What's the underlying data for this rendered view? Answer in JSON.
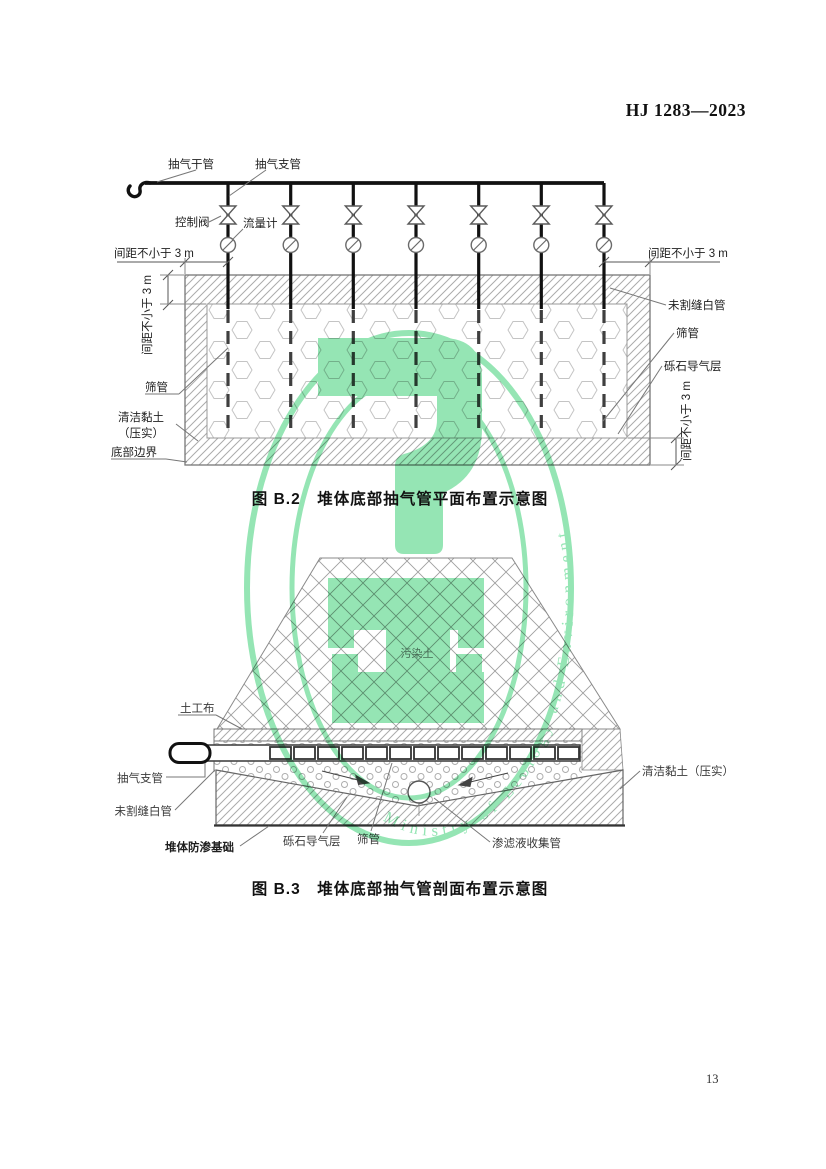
{
  "page": {
    "header": "HJ 1283—2023",
    "page_number": "13"
  },
  "figure_b2": {
    "caption": "图 B.2　堆体底部抽气管平面布置示意图",
    "labels": {
      "main_pipe": "抽气干管",
      "branch_pipe": "抽气支管",
      "control_valve": "控制阀",
      "flow_meter": "流量计",
      "spacing_top_left": "间距不小于 3 m",
      "spacing_top_right": "间距不小于 3 m",
      "spacing_side_left": "间距不小于 3 m",
      "spacing_side_right": "间距不小于 3 m",
      "unslotted_pipe": "未割缝白管",
      "screen_pipe_right": "筛管",
      "gravel_gas_layer": "砾石导气层",
      "screen_pipe_left": "筛管",
      "clean_clay_line1": "清洁黏土",
      "clean_clay_line2": "（压实）",
      "bottom_boundary": "底部边界"
    }
  },
  "figure_b3": {
    "caption": "图 B.3　堆体底部抽气管剖面布置示意图",
    "labels": {
      "geotextile": "土工布",
      "contaminated_soil": "污染土",
      "branch_pipe": "抽气支管",
      "unslotted_pipe": "未割缝白管",
      "foundation": "堆体防渗基础",
      "gravel_gas_layer": "砾石导气层",
      "screen_pipe": "筛管",
      "leachate_pipe": "渗滤液收集管",
      "clean_clay": "清洁黏土（压实）"
    }
  },
  "watermark": {
    "ring_text": "Ministry of Ecology and Environment",
    "color": "#7de0a4"
  }
}
